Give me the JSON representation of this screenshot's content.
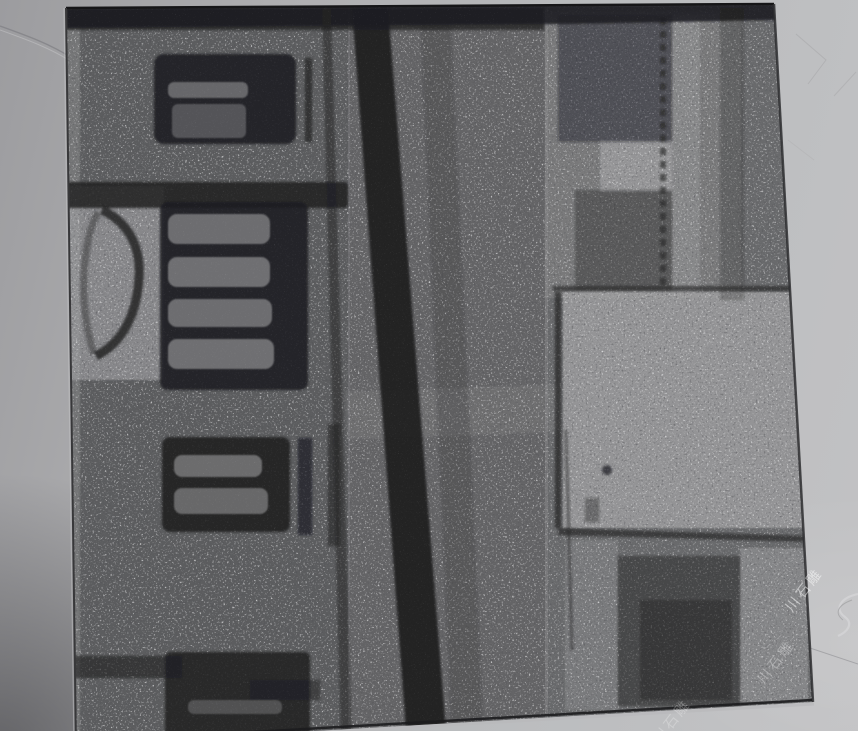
{
  "scene": {
    "description": "Photograph of a square black-granite tile engraved with an architectural photo, lying on a cracked gray concrete floor",
    "floor_color": "#b2b2b4",
    "floor_shadow_color": "#7e7e82"
  },
  "tile": {
    "granite_base_color": "#4b4c4e",
    "etch_dark_color": "#1f1f21",
    "etch_light_color": "#a6a6a8",
    "regions": {
      "top_border": "dark etched band along top edge",
      "building_facade": "left: wall with three dark windows",
      "upper_window": "small dark window with light inner panes",
      "emblem": "light panel with dark circular wreath ring",
      "middle_window": "large dark window, four light horizontal slats",
      "lower_window": "dark window, two light slats",
      "pole": "dark vertical pole leaning right, full height",
      "bright_square": "large light square patch, middle right",
      "upper_right_panel": "etched panel with light and dark blocks",
      "lower_right_patch": "dark rectangular patch, bottom right"
    }
  },
  "watermark": {
    "text": "川石雕",
    "color": "#ffffff"
  }
}
